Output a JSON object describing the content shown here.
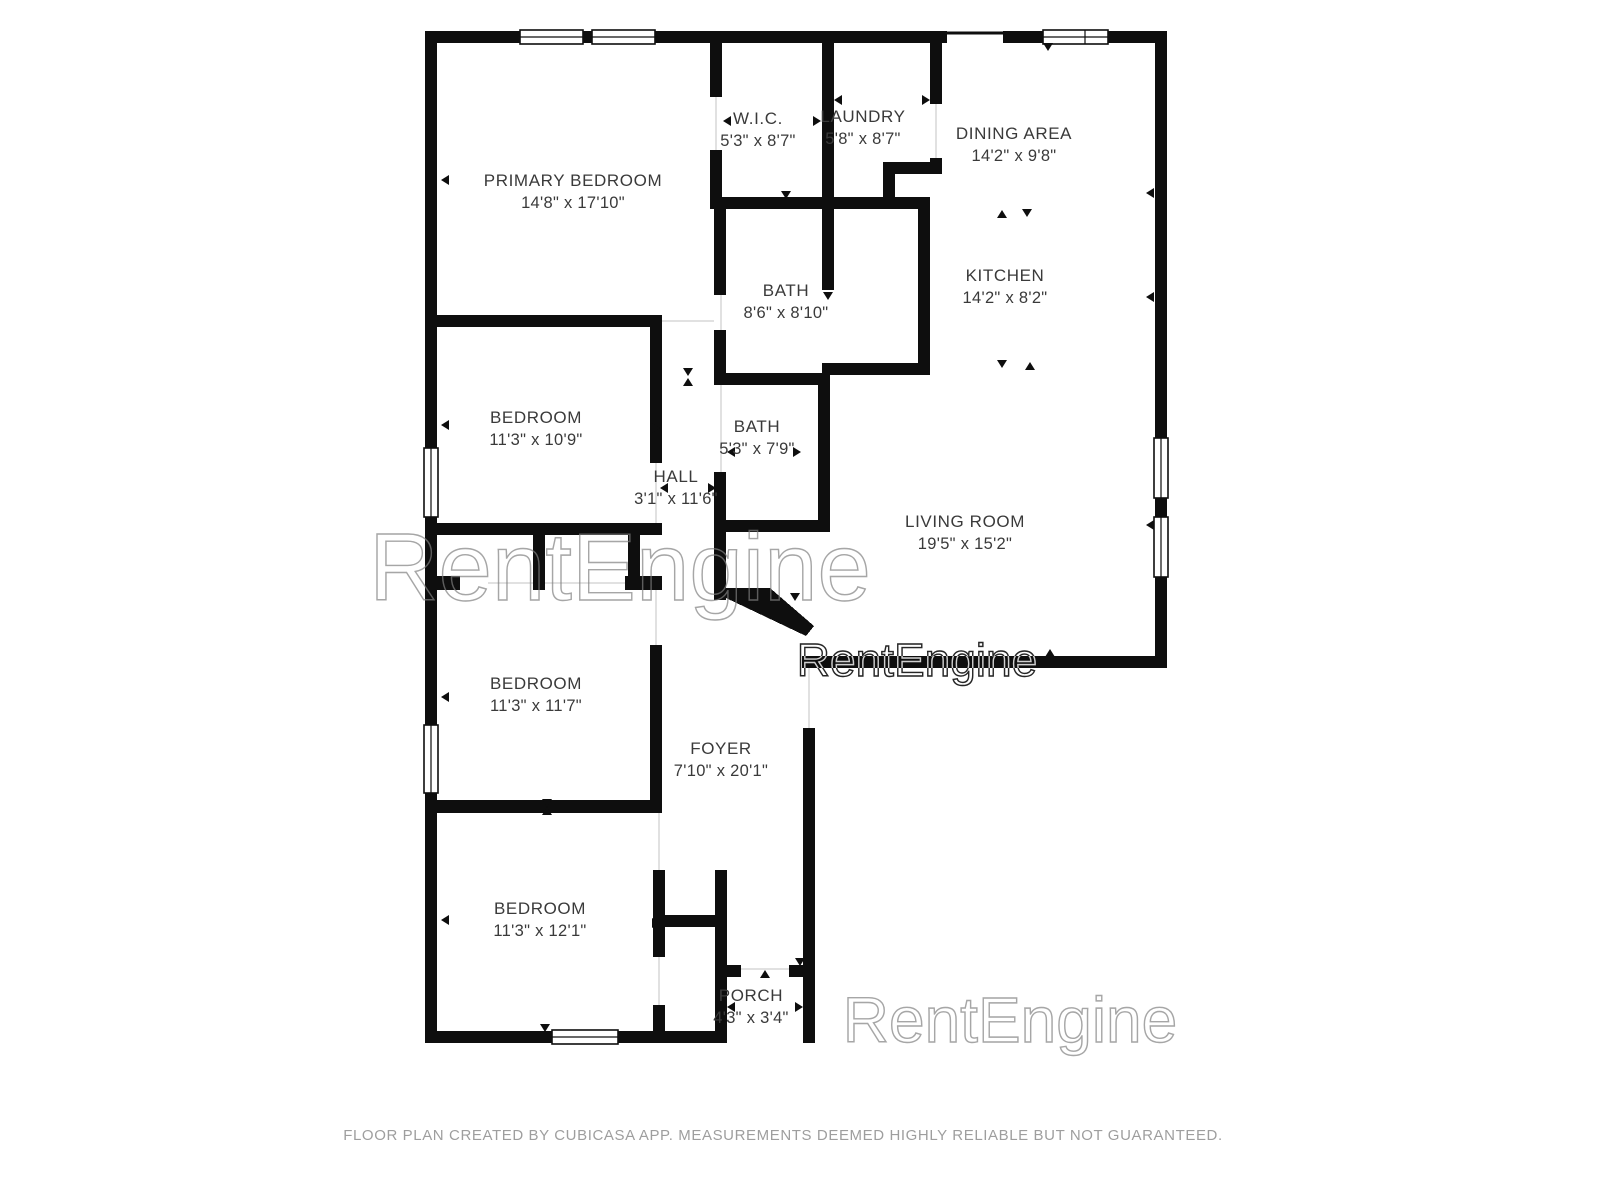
{
  "colors": {
    "wall": "#0e0e0e",
    "label": "#3a3a3a",
    "footer": "#9e9e9e"
  },
  "watermark": {
    "text": "RentEngine",
    "instances": [
      {
        "x": 917,
        "y": 676,
        "size": 46,
        "opacity": 0.85
      },
      {
        "x": 620,
        "y": 600,
        "size": 96,
        "opacity": 0.35
      },
      {
        "x": 1010,
        "y": 1042,
        "size": 64,
        "opacity": 0.35
      }
    ]
  },
  "rooms": [
    {
      "id": "primary-bedroom",
      "name": "PRIMARY BEDROOM",
      "dims": "14'8\" x 17'10\"",
      "x": 573,
      "y": 192
    },
    {
      "id": "wic",
      "name": "W.I.C.",
      "dims": "5'3\" x 8'7\"",
      "x": 758,
      "y": 130
    },
    {
      "id": "laundry",
      "name": "LAUNDRY",
      "dims": "5'8\" x 8'7\"",
      "x": 863,
      "y": 128
    },
    {
      "id": "dining-area",
      "name": "DINING AREA",
      "dims": "14'2\" x 9'8\"",
      "x": 1014,
      "y": 145
    },
    {
      "id": "kitchen",
      "name": "KITCHEN",
      "dims": "14'2\" x 8'2\"",
      "x": 1005,
      "y": 287
    },
    {
      "id": "bath-main",
      "name": "BATH",
      "dims": "8'6\" x 8'10\"",
      "x": 786,
      "y": 302
    },
    {
      "id": "bedroom-1",
      "name": "BEDROOM",
      "dims": "11'3\" x 10'9\"",
      "x": 536,
      "y": 429
    },
    {
      "id": "bath-hall",
      "name": "BATH",
      "dims": "5'3\" x 7'9\"",
      "x": 757,
      "y": 438
    },
    {
      "id": "hall",
      "name": "HALL",
      "dims": "3'1\" x 11'6\"",
      "x": 676,
      "y": 488
    },
    {
      "id": "living-room",
      "name": "LIVING ROOM",
      "dims": "19'5\" x 15'2\"",
      "x": 965,
      "y": 533
    },
    {
      "id": "bedroom-2",
      "name": "BEDROOM",
      "dims": "11'3\" x 11'7\"",
      "x": 536,
      "y": 695
    },
    {
      "id": "foyer",
      "name": "FOYER",
      "dims": "7'10\" x 20'1\"",
      "x": 721,
      "y": 760
    },
    {
      "id": "bedroom-3",
      "name": "BEDROOM",
      "dims": "11'3\" x 12'1\"",
      "x": 540,
      "y": 920
    },
    {
      "id": "porch",
      "name": "PORCH",
      "dims": "4'3\" x 3'4\"",
      "x": 751,
      "y": 1007
    }
  ],
  "footer": {
    "text": "FLOOR PLAN CREATED BY CUBICASA APP. MEASUREMENTS DEEMED HIGHLY RELIABLE BUT NOT GUARANTEED."
  }
}
